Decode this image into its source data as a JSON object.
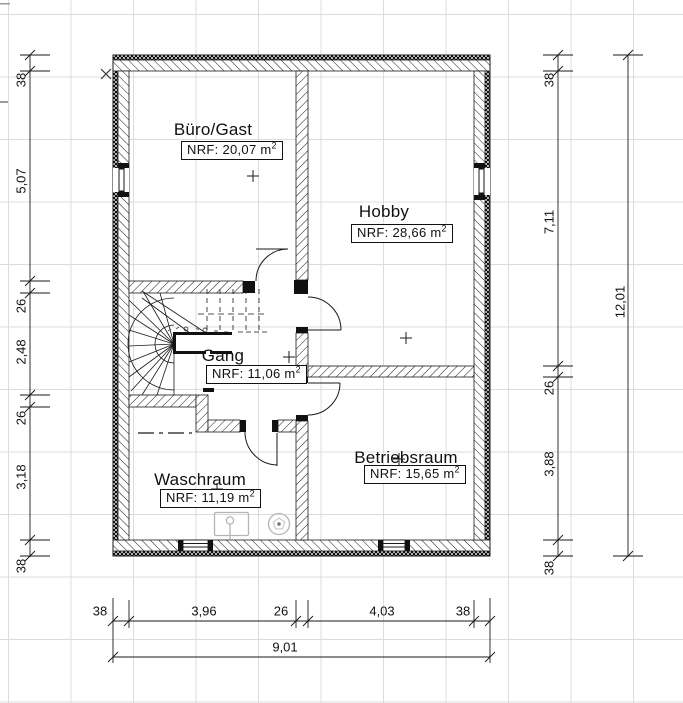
{
  "drawing": {
    "rooms": [
      {
        "name": "Büro/Gast",
        "nrf": "NRF: 20,07 m",
        "nrf_sup": "2"
      },
      {
        "name": "Hobby",
        "nrf": "NRF: 28,66 m",
        "nrf_sup": "2"
      },
      {
        "name": "Gang",
        "nrf": "NRF: 11,06 m",
        "nrf_sup": "2"
      },
      {
        "name": "Waschraum",
        "nrf": "NRF: 11,19 m",
        "nrf_sup": "2"
      },
      {
        "name": "Betriebsraum",
        "nrf": "NRF: 15,65 m",
        "nrf_sup": "2"
      }
    ],
    "dimensions": {
      "left": [
        "38",
        "5,07",
        "26",
        "2,48",
        "26",
        "3,18",
        "38"
      ],
      "right": [
        "38",
        "7,11",
        "26",
        "3,88",
        "38"
      ],
      "right_total": "12,01",
      "bottom": [
        "38",
        "3,96",
        "26",
        "4,03",
        "38"
      ],
      "bottom_total": "9,01"
    },
    "colors": {
      "line": "#1a1a1a",
      "grid": "#dcdcdc",
      "fixture": "#b5b5b5",
      "background": "#ffffff"
    }
  }
}
